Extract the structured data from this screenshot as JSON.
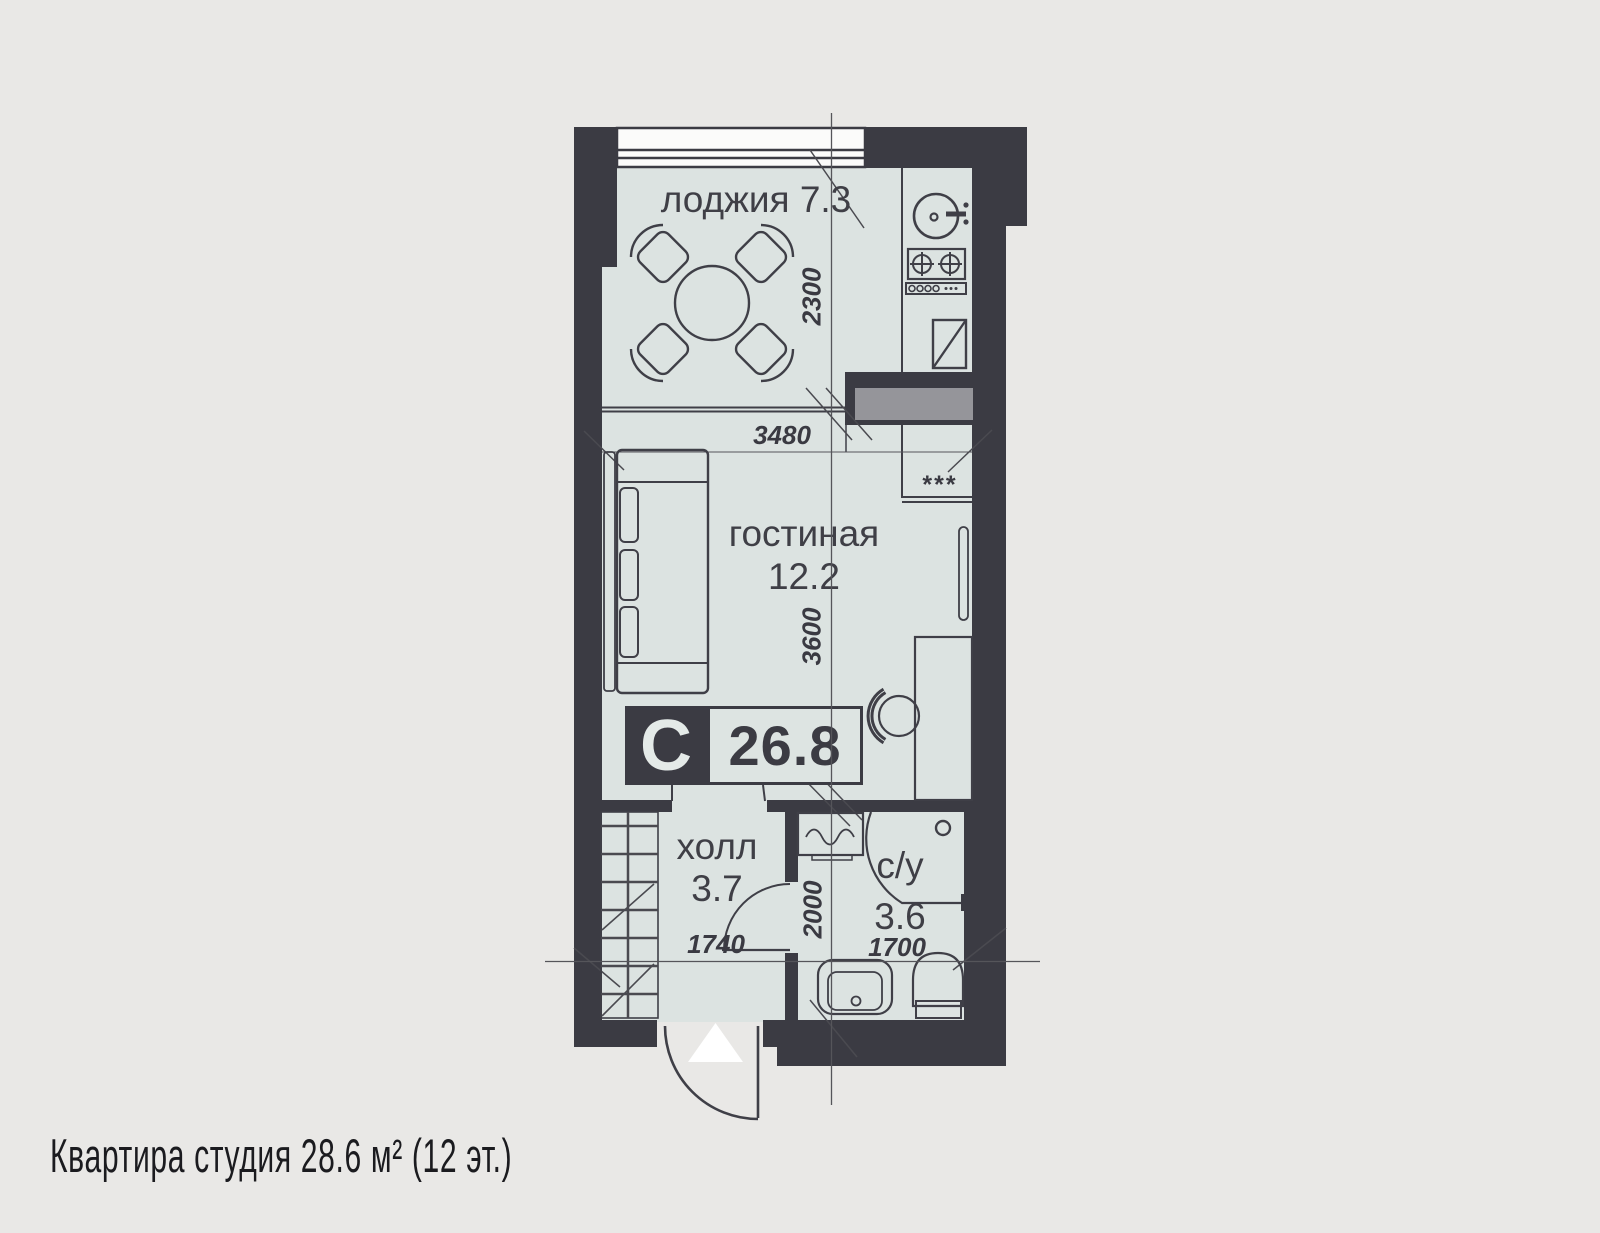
{
  "caption": "Квартира студия 28.6 м² (12 эт.)",
  "rooms": [
    {
      "name": "лоджия",
      "area": "7.3"
    },
    {
      "name": "гостиная",
      "area": "12.2"
    },
    {
      "name": "холл",
      "area": "3.7"
    },
    {
      "name": "с/у",
      "area": "3.6"
    }
  ],
  "badge": {
    "letter": "С",
    "total_area": "26.8"
  },
  "dims": {
    "living_width": "3480",
    "loggia_depth": "2300",
    "living_depth": "3600",
    "bath_door_wall": "2000",
    "hall_width": "1740",
    "bath_width": "1700"
  },
  "marks": {
    "freezer": "***"
  },
  "colors": {
    "background": "#e9e8e6",
    "wall": "#3b3b43",
    "floor": "#dce3e1",
    "duct_fill": "#95959a",
    "stroke": "#3f3f47",
    "glazing": "#fbfbfa",
    "entry_triangle": "#ffffff"
  }
}
